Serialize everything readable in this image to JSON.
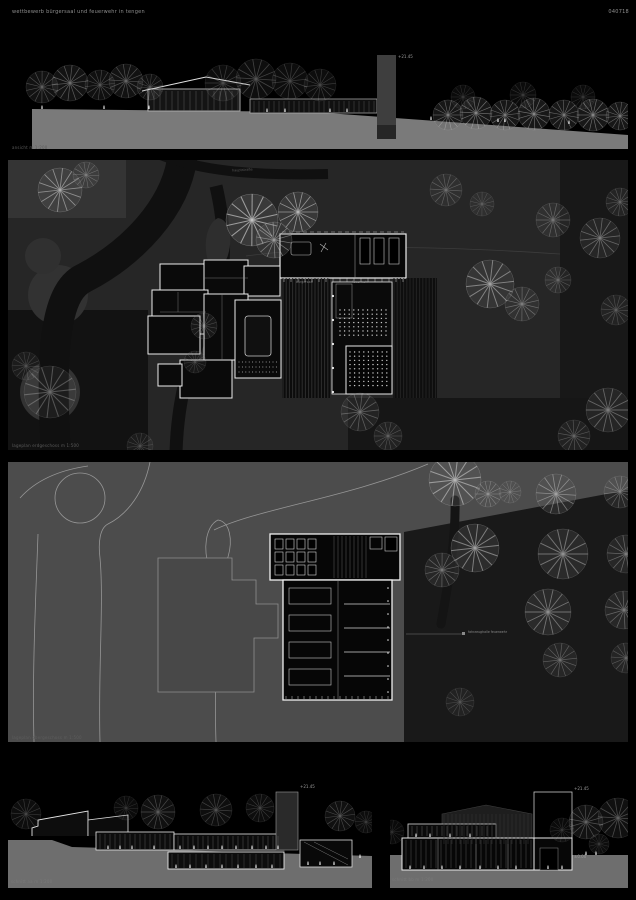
{
  "sheet": {
    "title": "wettbewerb bürgersaal und feuerwehr in tengen",
    "code": "040718"
  },
  "panels": {
    "elevation": {
      "caption": "ansicht  m 1:200",
      "tower_marker": "+21.45"
    },
    "site_plan_ground": {
      "caption": "lageplan erdgeschoss  m 1:500",
      "street_label": "hauptstraße",
      "hall_label": "bürgersaal",
      "firestation_label": "feuerwehr"
    },
    "site_plan_upper": {
      "caption": "lageplan obergeschoss  m 1:500",
      "leader_label": "fahrzeughalle feuerwehr"
    },
    "section_a": {
      "caption": "schnitt aa  m 1:200",
      "tower_marker": "+21.45"
    },
    "section_b": {
      "caption": "schnitt bb  m 1:200",
      "marker_top": "+21.45",
      "marker_base": "±0.00"
    }
  },
  "colors": {
    "background": "#000000",
    "ground_gray": "#6e6e6e",
    "plan_line": "#f0f0f0",
    "site_dark": "#141414",
    "site_gray": "#2b2b2b",
    "upper_gray": "#4c4c4c",
    "text_gray": "#8f8f8f"
  }
}
